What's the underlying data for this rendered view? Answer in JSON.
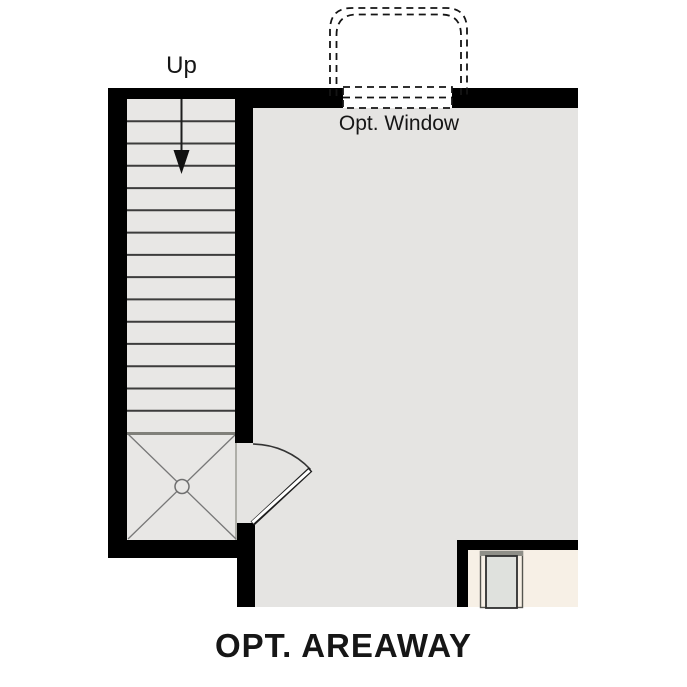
{
  "plan": {
    "title": "OPT. AREAWAY",
    "stairs": {
      "label": "Up",
      "tread_count": 15
    },
    "window": {
      "label": "Opt. Window"
    }
  },
  "colors": {
    "wall": "#000000",
    "room_fill": "#e5e4e2",
    "stair_fill": "#e8e7e5",
    "adjacent_room_fill": "#f7f0e6",
    "door_slab_fill": "#dfe1dd",
    "line_dark": "#3c3c3c",
    "background": "#ffffff"
  }
}
